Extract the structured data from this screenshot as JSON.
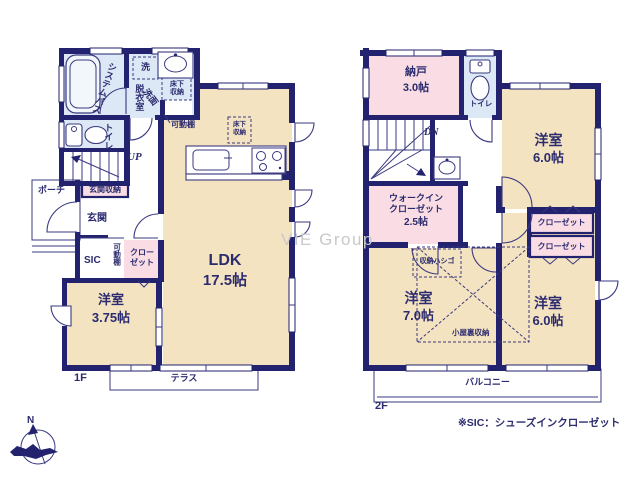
{
  "colors": {
    "wall": "#22226f",
    "ink": "#2b2b6f",
    "room-cream": "#f4e3c1",
    "wet-blue": "#dce8f5",
    "closet-pink": "#fadde4",
    "watermark-gray": "#c9c9c9",
    "fixture-line": "#3a3a80"
  },
  "watermark": "VIE Group",
  "footnote": "※SIC：シューズインクローゼット",
  "compass": {
    "north": "N"
  },
  "f1": {
    "label": "1F",
    "terrace": "テラス",
    "bath": "システムバス",
    "washer": "洗",
    "dressing_room": "脱衣室",
    "vanity": "洗面",
    "underfloor_storage": "床下収納",
    "movable_shelf_note": "可動棚",
    "toilet": "トイレ",
    "stairs_up": "UP",
    "porch": "ポーチ",
    "entrance_storage": "玄関収納",
    "entrance": "玄関",
    "sic": "SIC",
    "movable_shelf": "可動棚",
    "closet": "クローゼット",
    "bedroom_name": "洋室",
    "bedroom_size": "3.75帖",
    "ldk_name": "LDK",
    "ldk_size": "17.5帖",
    "underfloor_storage_ldk": "床下収納"
  },
  "f2": {
    "label": "2F",
    "balcony": "バルコニー",
    "storage_room_name": "納戸",
    "storage_room_size": "3.0帖",
    "toilet": "トイレ",
    "stairs_down": "DN",
    "bedroom_ne_name": "洋室",
    "bedroom_ne_size": "6.0帖",
    "wic_name": "ウォークインクローゼット",
    "wic_size": "2.5帖",
    "closet1": "クローゼット",
    "closet2": "クローゼット",
    "storage_ladder": "収納ハシゴ",
    "bedroom_sw_name": "洋室",
    "bedroom_sw_size": "7.0帖",
    "bedroom_se_name": "洋室",
    "bedroom_se_size": "6.0帖",
    "attic_storage": "小屋裏収納"
  }
}
